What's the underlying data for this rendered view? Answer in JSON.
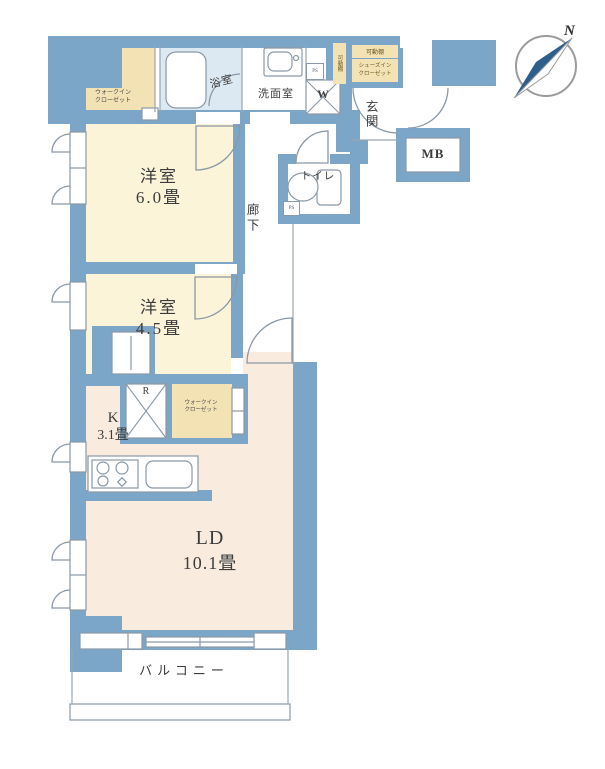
{
  "labels": {
    "room1_name": "洋室",
    "room1_size": "6.0畳",
    "room2_name": "洋室",
    "room2_size": "4.5畳",
    "kitchen_name": "K",
    "kitchen_size": "3.1畳",
    "ld_name": "LD",
    "ld_size": "10.1畳",
    "balcony": "バルコニー",
    "entrance": "玄関",
    "hallway": "廊下",
    "toilet": "トイレ",
    "washroom": "洗面室",
    "bathroom": "浴室",
    "washer": "W",
    "fridge": "R",
    "meter_box": "MB",
    "ps1": "PS",
    "ps2": "PS",
    "wic1_line1": "ウォークイン",
    "wic1_line2": "クローゼット",
    "wic2_line1": "ウォークイン",
    "wic2_line2": "クローゼット",
    "shelf_vertical": "可動棚",
    "shelf_horizontal": "可動棚",
    "sic_line1": "シューズイン",
    "sic_line2": "クローゼット",
    "north": "N"
  },
  "colors": {
    "wall": "#7ca6c7",
    "room_cream": "#fcf4d9",
    "ld_peach": "#f9ecdf",
    "closet_tan": "#f2e2b4",
    "bath_blue": "#dde9f2",
    "outline": "#8a99a8",
    "text": "#3c3c3c",
    "compass_needle": "#2d5f8c"
  }
}
